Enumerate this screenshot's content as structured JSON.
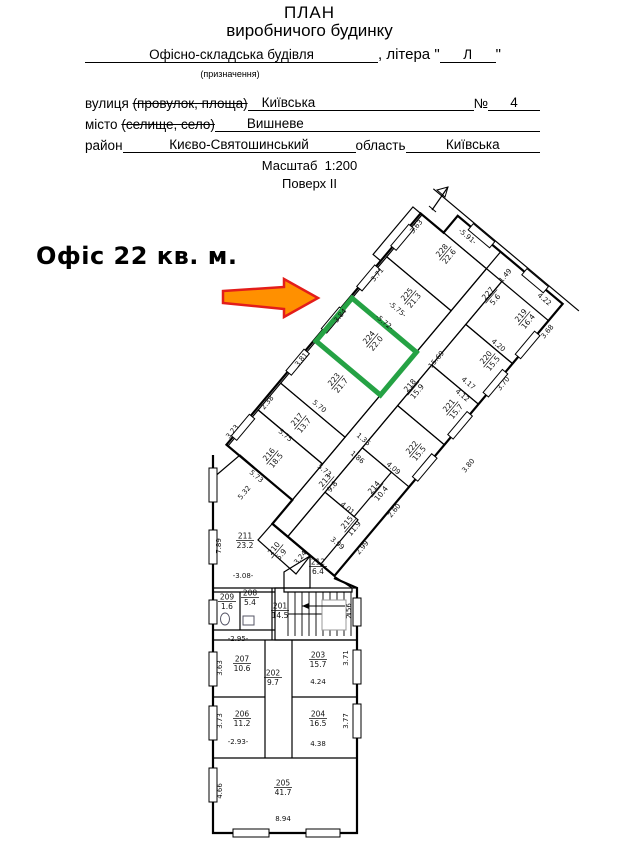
{
  "header": {
    "title1": "ПЛАН",
    "title2": "виробничого будинку",
    "building_type": "Офісно-складська будівля",
    "litera_prefix": ", літера \"",
    "litera_value": "Л",
    "litera_suffix": "\"",
    "purpose_note": "(призначення)",
    "street_label": "вулиця",
    "street_label_struck": "(провулок, площа)",
    "street_value": "Київська",
    "number_label": "№",
    "number_value": "4",
    "city_label": "місто",
    "city_label_struck": "(селище, село)",
    "city_value": "Вишневе",
    "district_label": "район",
    "district_value": "Києво-Святошинський",
    "region_label": "область",
    "region_value": "Київська",
    "scale_label": "Масштаб",
    "scale_value": "1:200",
    "floor_label": "Поверх II"
  },
  "annotation": {
    "label": "Офіс 22 кв. м.",
    "arrow_fill": "#ff9000",
    "arrow_stroke": "#e31d1a"
  },
  "plan": {
    "highlight_room": "224",
    "highlight_color": "#25a244",
    "rooms": [
      {
        "n": "228",
        "a": "22.6",
        "x": 445,
        "y": 253,
        "r": -50
      },
      {
        "n": "225",
        "a": "21.3",
        "x": 410,
        "y": 297,
        "r": -50
      },
      {
        "n": "227",
        "a": "5.6",
        "x": 491,
        "y": 296,
        "r": -50
      },
      {
        "n": "224",
        "a": "22.0",
        "x": 372,
        "y": 340,
        "r": -50
      },
      {
        "n": "223",
        "a": "21.7",
        "x": 337,
        "y": 382,
        "r": -50
      },
      {
        "n": "219",
        "a": "16.4",
        "x": 524,
        "y": 318,
        "r": -50
      },
      {
        "n": "220",
        "a": "15.5",
        "x": 489,
        "y": 360,
        "r": -50
      },
      {
        "n": "221",
        "a": "15.7",
        "x": 452,
        "y": 408,
        "r": -50
      },
      {
        "n": "222",
        "a": "15.5",
        "x": 415,
        "y": 450,
        "r": -50
      },
      {
        "n": "218",
        "a": "15.9",
        "x": 413,
        "y": 388,
        "r": -50
      },
      {
        "n": "217",
        "a": "13.7",
        "x": 300,
        "y": 422,
        "r": -50
      },
      {
        "n": "216",
        "a": "18.5",
        "x": 272,
        "y": 457,
        "r": -50
      },
      {
        "n": "213",
        "a": "9.8",
        "x": 328,
        "y": 483,
        "r": -50
      },
      {
        "n": "214",
        "a": "10.4",
        "x": 377,
        "y": 490,
        "r": -50
      },
      {
        "n": "215",
        "a": "11.9",
        "x": 350,
        "y": 525,
        "r": -50
      },
      {
        "n": "210",
        "a": "5.9",
        "x": 277,
        "y": 551,
        "r": -50
      },
      {
        "n": "212",
        "a": "6.4",
        "x": 318,
        "y": 566,
        "r": 0
      },
      {
        "n": "211",
        "a": "23.2",
        "x": 245,
        "y": 540,
        "r": 0
      },
      {
        "n": "209",
        "a": "1.6",
        "x": 227,
        "y": 601,
        "r": 0
      },
      {
        "n": "208",
        "a": "5.4",
        "x": 250,
        "y": 597,
        "r": 0
      },
      {
        "n": "201",
        "a": "14.5",
        "x": 280,
        "y": 610,
        "r": 0
      },
      {
        "n": "207",
        "a": "10.6",
        "x": 242,
        "y": 663,
        "r": 0
      },
      {
        "n": "202",
        "a": "9.7",
        "x": 273,
        "y": 677,
        "r": 0
      },
      {
        "n": "203",
        "a": "15.7",
        "x": 318,
        "y": 659,
        "r": 0
      },
      {
        "n": "206",
        "a": "11.2",
        "x": 242,
        "y": 718,
        "r": 0
      },
      {
        "n": "204",
        "a": "16.5",
        "x": 318,
        "y": 718,
        "r": 0
      },
      {
        "n": "205",
        "a": "41.7",
        "x": 283,
        "y": 787,
        "r": 0
      }
    ],
    "dims": [
      {
        "t": "3.63",
        "x": 418,
        "y": 228,
        "r": -50
      },
      {
        "t": "-5.91-",
        "x": 466,
        "y": 238,
        "r": 40
      },
      {
        "t": "1.49",
        "x": 507,
        "y": 277,
        "r": -50
      },
      {
        "t": "4.22",
        "x": 543,
        "y": 301,
        "r": 40
      },
      {
        "t": "3.68",
        "x": 549,
        "y": 333,
        "r": -50
      },
      {
        "t": "3.71",
        "x": 379,
        "y": 276,
        "r": -50
      },
      {
        "t": "-5.75-",
        "x": 396,
        "y": 311,
        "r": 40
      },
      {
        "t": "-5.72-",
        "x": 383,
        "y": 324,
        "r": 40
      },
      {
        "t": "3.84",
        "x": 342,
        "y": 317,
        "r": -50
      },
      {
        "t": "3.81",
        "x": 303,
        "y": 361,
        "r": -50
      },
      {
        "t": "5.70",
        "x": 318,
        "y": 408,
        "r": 40
      },
      {
        "t": "2.38",
        "x": 269,
        "y": 404,
        "r": -50
      },
      {
        "t": "5.75",
        "x": 284,
        "y": 437,
        "r": 40
      },
      {
        "t": "3.23",
        "x": 234,
        "y": 433,
        "r": -50
      },
      {
        "t": "5.73",
        "x": 255,
        "y": 478,
        "r": 40
      },
      {
        "t": "5.73",
        "x": 323,
        "y": 472,
        "r": 40
      },
      {
        "t": "5.32",
        "x": 246,
        "y": 494,
        "r": -50
      },
      {
        "t": "15.69",
        "x": 438,
        "y": 361,
        "r": -50
      },
      {
        "t": "4.20",
        "x": 497,
        "y": 347,
        "r": 40
      },
      {
        "t": "4.17",
        "x": 467,
        "y": 385,
        "r": 40
      },
      {
        "t": "4.12",
        "x": 461,
        "y": 397,
        "r": 40
      },
      {
        "t": "3.70",
        "x": 505,
        "y": 385,
        "r": -50
      },
      {
        "t": "3.80",
        "x": 470,
        "y": 467,
        "r": -50
      },
      {
        "t": "4.09",
        "x": 392,
        "y": 470,
        "r": 40
      },
      {
        "t": "2.60",
        "x": 396,
        "y": 512,
        "r": -50
      },
      {
        "t": "4.01",
        "x": 346,
        "y": 510,
        "r": 40
      },
      {
        "t": "3.99",
        "x": 336,
        "y": 545,
        "r": 40
      },
      {
        "t": "2.99",
        "x": 364,
        "y": 549,
        "r": -50
      },
      {
        "t": "1.36",
        "x": 362,
        "y": 441,
        "r": 40
      },
      {
        "t": "1.86",
        "x": 356,
        "y": 459,
        "r": 40
      },
      {
        "t": "3.24",
        "x": 302,
        "y": 559,
        "r": -50
      },
      {
        "t": "7.89",
        "x": 221,
        "y": 546,
        "r": -90
      },
      {
        "t": "-3.08-",
        "x": 243,
        "y": 578,
        "r": 0
      },
      {
        "t": "2.56",
        "x": 351,
        "y": 611,
        "r": -90
      },
      {
        "t": "-2.95-",
        "x": 238,
        "y": 641,
        "r": 0
      },
      {
        "t": "3.63",
        "x": 222,
        "y": 668,
        "r": -90
      },
      {
        "t": "3.71",
        "x": 348,
        "y": 658,
        "r": -90
      },
      {
        "t": "4.24",
        "x": 318,
        "y": 684,
        "r": 0
      },
      {
        "t": "3.73",
        "x": 222,
        "y": 721,
        "r": -90
      },
      {
        "t": "-2.93-",
        "x": 238,
        "y": 744,
        "r": 0
      },
      {
        "t": "3.77",
        "x": 348,
        "y": 721,
        "r": -90
      },
      {
        "t": "4.38",
        "x": 318,
        "y": 746,
        "r": 0
      },
      {
        "t": "4.66",
        "x": 222,
        "y": 791,
        "r": -90
      },
      {
        "t": "8.94",
        "x": 283,
        "y": 821,
        "r": 0
      }
    ]
  }
}
